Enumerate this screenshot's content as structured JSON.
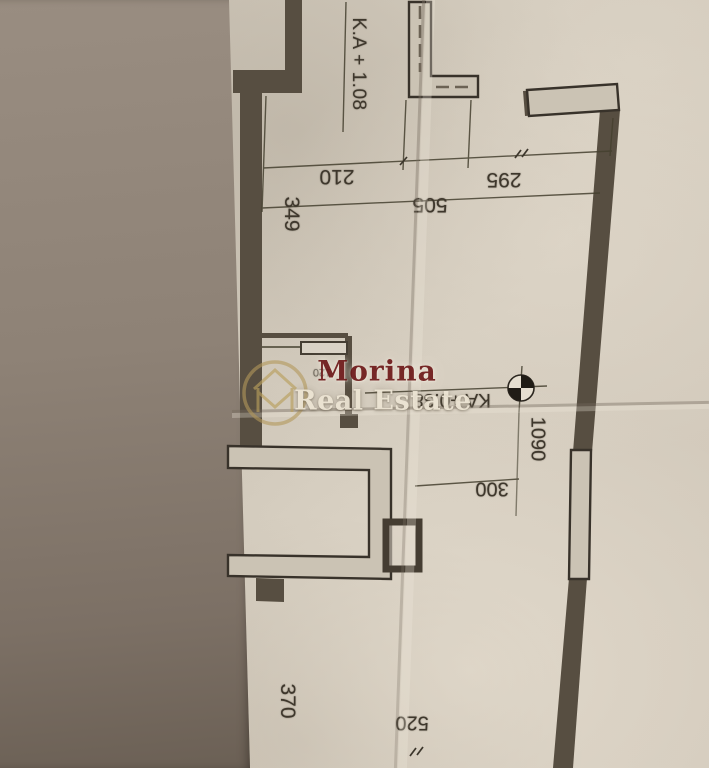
{
  "document": {
    "kind": "floor-plan-photo"
  },
  "watermark": {
    "brand": "Morina",
    "tagline": "Real Estate",
    "logo": "house-monogram-circle",
    "brand_color": "#6f1b1b",
    "tagline_color": "#ece4d3",
    "logo_color": "#b39a5e"
  },
  "levels": {
    "upper": "K.A + 1.08",
    "middle": "KA +0.38"
  },
  "dimensions": {
    "top_left": "210",
    "top_right": "295",
    "top_total": "505",
    "left_upper": "349",
    "right_wall": "1090",
    "middle": "300",
    "left_lower": "370",
    "bottom": "520",
    "door": "120"
  },
  "symbols": {
    "level_marker": "benchmark-crosshair-icon"
  }
}
